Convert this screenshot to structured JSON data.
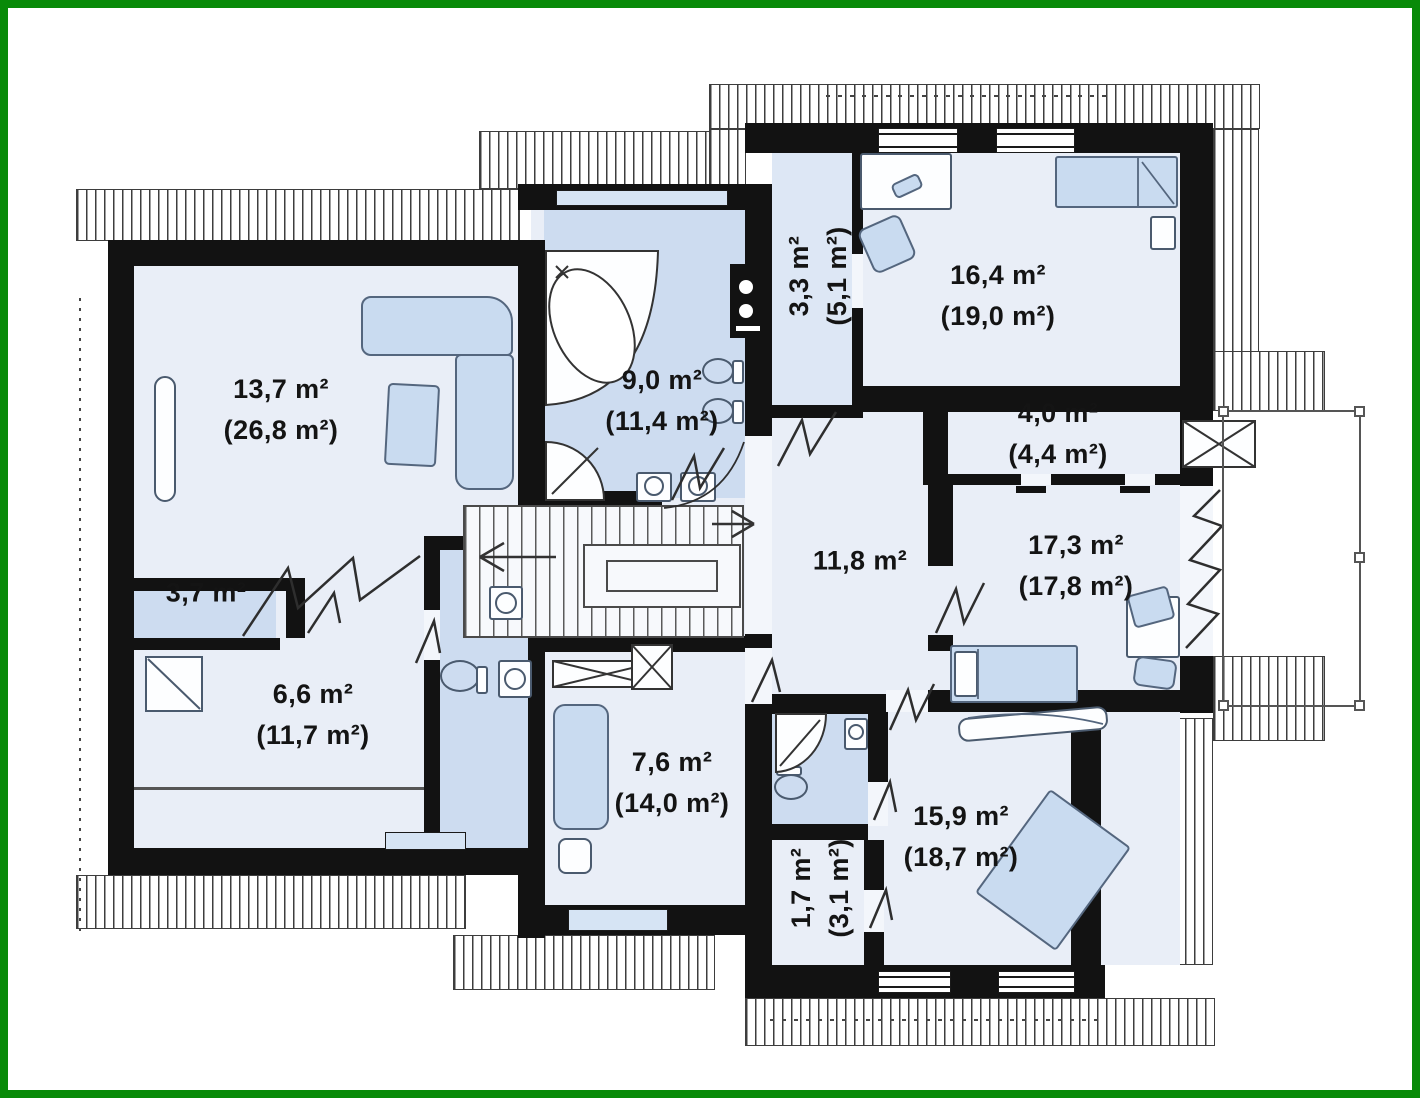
{
  "plan": {
    "type": "floor-plan",
    "frame_color": "#088a08",
    "wall_color": "#121212",
    "floor_color": "#e9eef7",
    "wet_room_color": "#cddcf0",
    "furniture_color": "#c9dbf0",
    "hatch_color": "#3d3d3d"
  },
  "rooms": [
    {
      "id": "living-room",
      "area": "13,7 m²",
      "area_total": "(26,8 m²)",
      "orientation": "horizontal"
    },
    {
      "id": "bathroom",
      "area": "9,0 m²",
      "area_total": "(11,4 m²)",
      "orientation": "horizontal"
    },
    {
      "id": "corridor",
      "area": "3,3 m²",
      "area_total": "(5,1 m²)",
      "orientation": "vertical"
    },
    {
      "id": "bedroom-1",
      "area": "16,4 m²",
      "area_total": "(19,0 m²)",
      "orientation": "horizontal"
    },
    {
      "id": "closet",
      "area": "4,0 m²",
      "area_total": "(4,4 m²)",
      "orientation": "horizontal"
    },
    {
      "id": "hall",
      "area": "11,8 m²",
      "area_total": "",
      "orientation": "horizontal"
    },
    {
      "id": "bedroom-2",
      "area": "17,3 m²",
      "area_total": "(17,8 m²)",
      "orientation": "horizontal"
    },
    {
      "id": "wardrobe",
      "area": "3,7 m²",
      "area_total": "",
      "orientation": "horizontal"
    },
    {
      "id": "bathroom-2",
      "area": "6,6 m²",
      "area_total": "(11,7 m²)",
      "orientation": "horizontal"
    },
    {
      "id": "room",
      "area": "7,6 m²",
      "area_total": "(14,0 m²)",
      "orientation": "horizontal"
    },
    {
      "id": "storage",
      "area": "1,7 m²",
      "area_total": "(3,1 m²)",
      "orientation": "vertical"
    },
    {
      "id": "bedroom-3",
      "area": "15,9 m²",
      "area_total": "(18,7 m²)",
      "orientation": "horizontal"
    }
  ],
  "icons": [
    "bathtub-icon",
    "shower-icon",
    "toilet-icon",
    "sink-icon",
    "washing-machine-icon",
    "bed-icon",
    "sofa-icon",
    "armchair-icon",
    "desk-icon",
    "chair-icon",
    "wardrobe-icon",
    "stairs-icon",
    "radiator-icon",
    "chimney-icon",
    "balcony-railing-icon",
    "door-opening-icon"
  ]
}
